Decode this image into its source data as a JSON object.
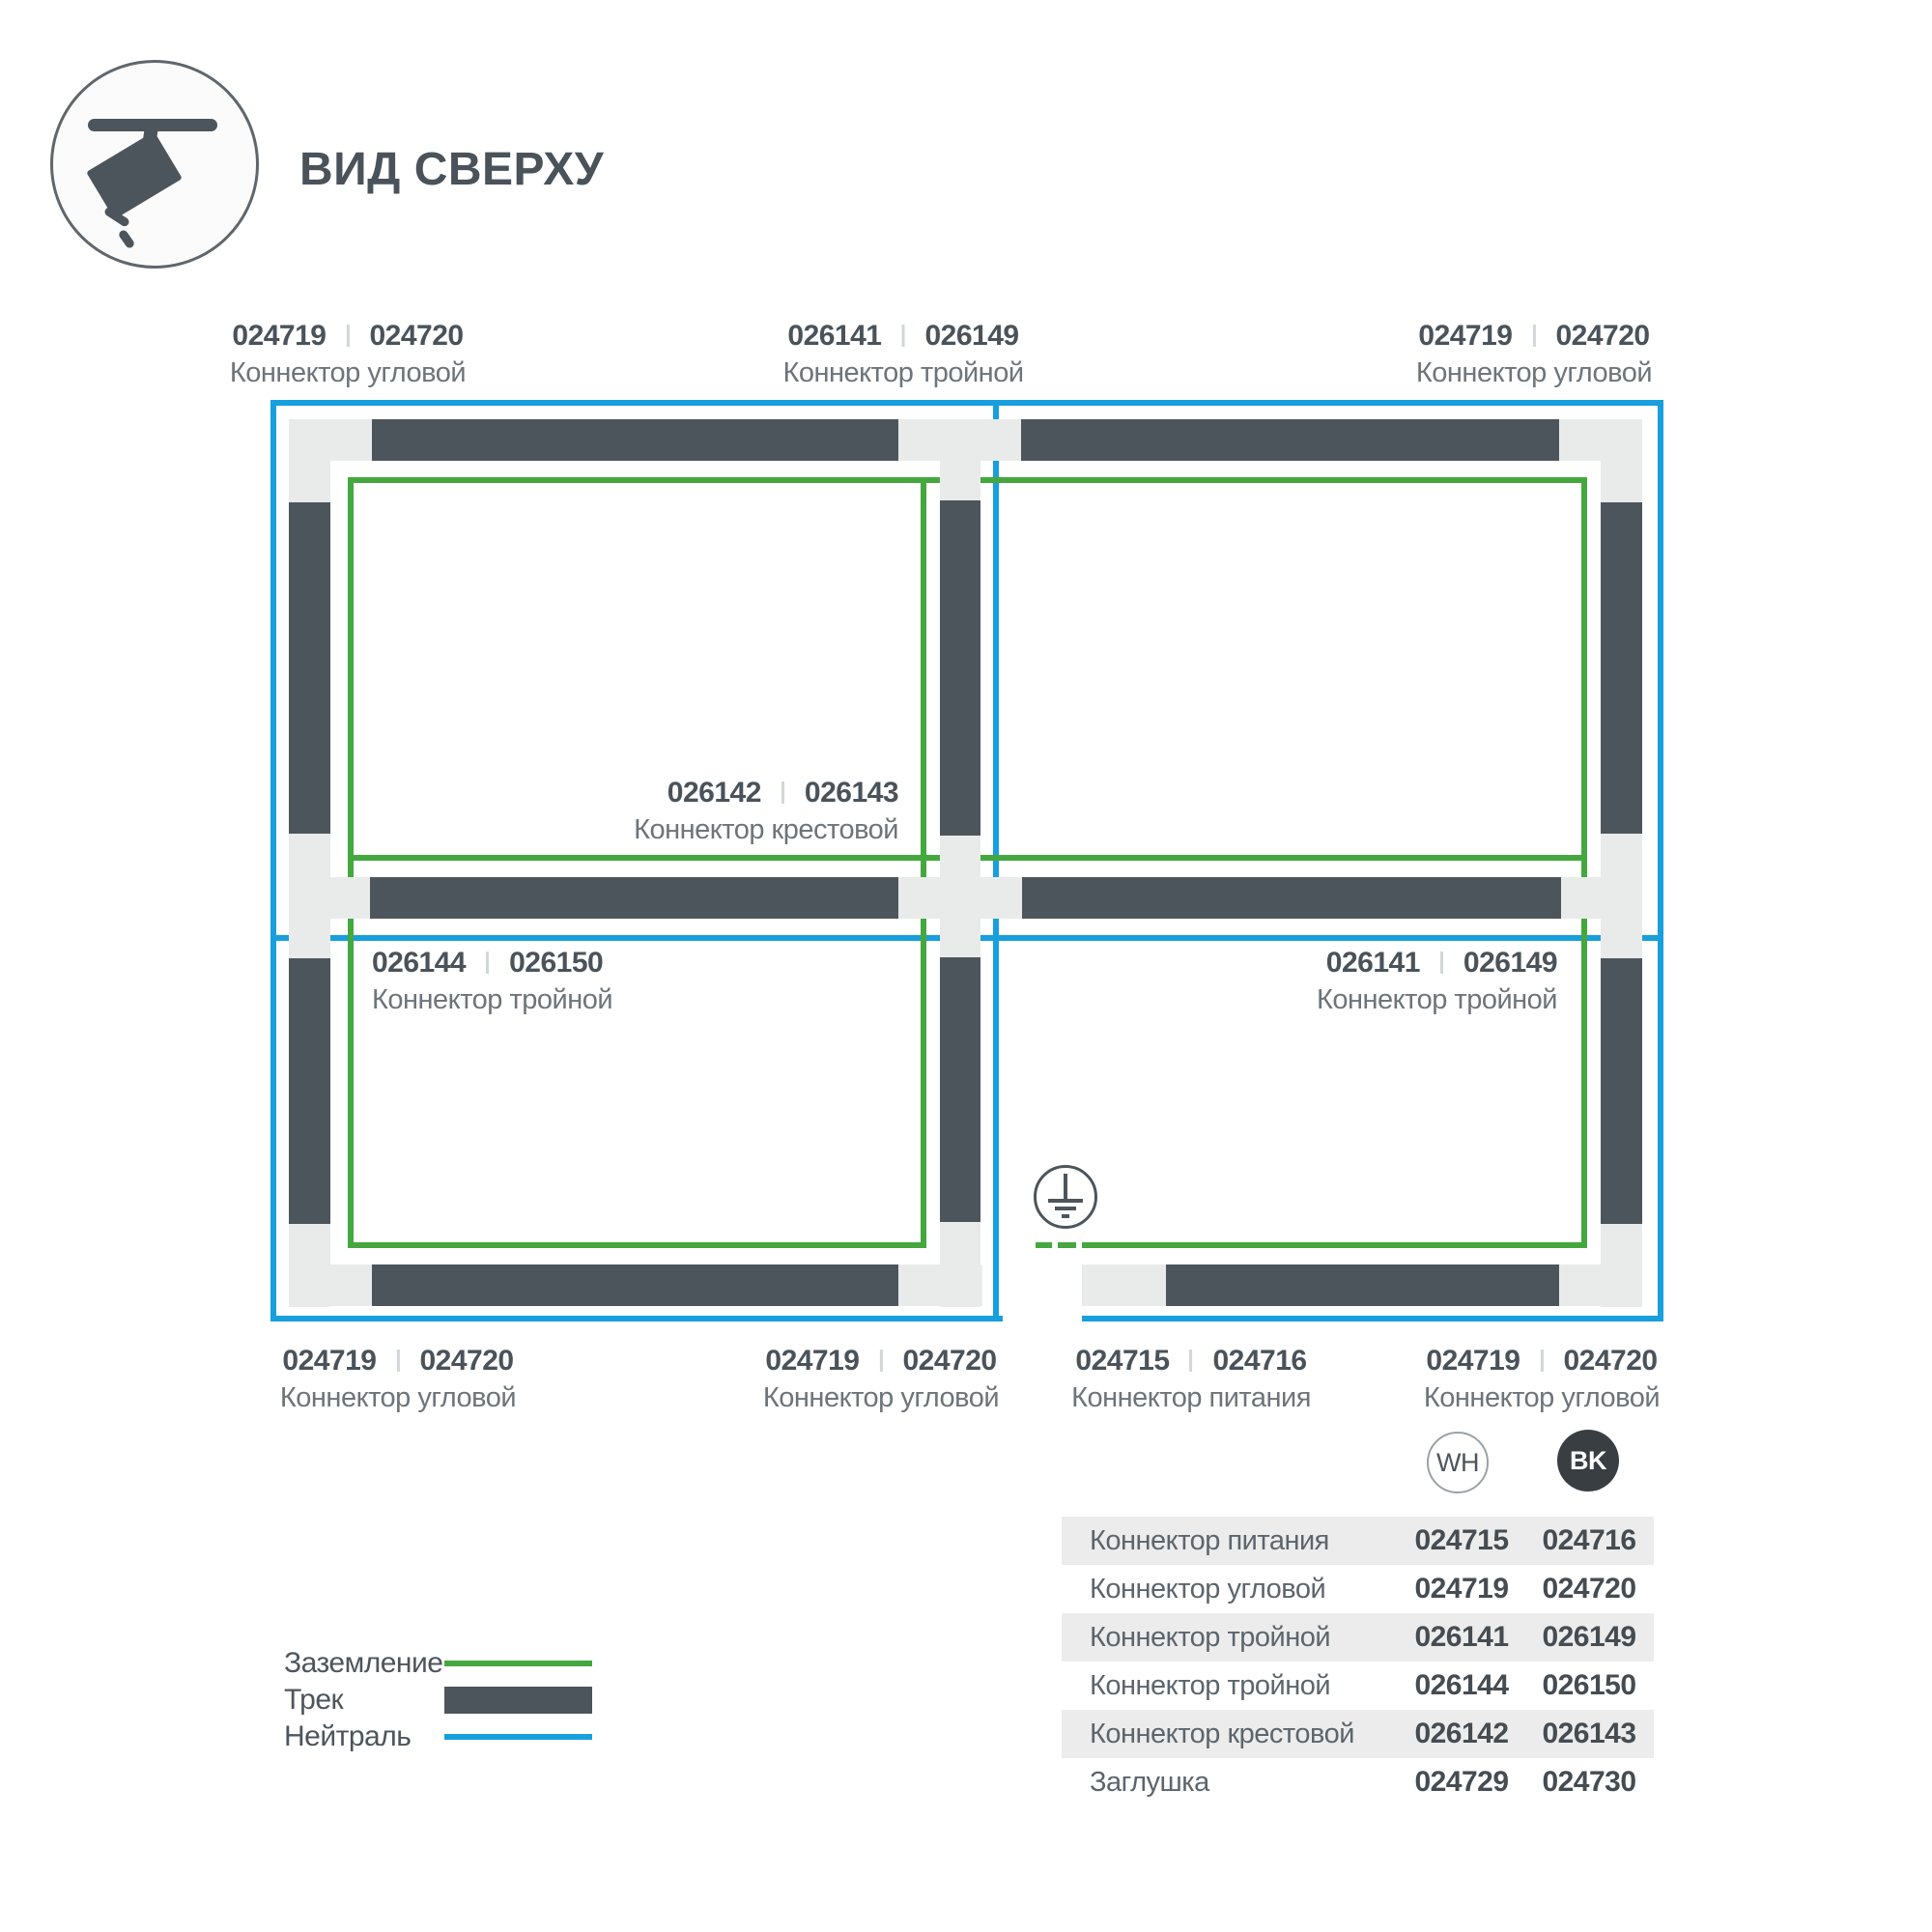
{
  "header": {
    "title": "ВИД СВЕРХУ"
  },
  "diagram": {
    "labels": [
      {
        "pos": "top-left",
        "wh": "024719",
        "bk": "024720",
        "name": "Коннектор угловой"
      },
      {
        "pos": "top-middle",
        "wh": "026141",
        "bk": "026149",
        "name": "Коннектор тройной"
      },
      {
        "pos": "top-right",
        "wh": "024719",
        "bk": "024720",
        "name": "Коннектор угловой"
      },
      {
        "pos": "center-cross",
        "wh": "026142",
        "bk": "026143",
        "name": "Коннектор крестовой"
      },
      {
        "pos": "middle-left",
        "wh": "026144",
        "bk": "026150",
        "name": "Коннектор тройной"
      },
      {
        "pos": "middle-right",
        "wh": "026141",
        "bk": "026149",
        "name": "Коннектор тройной"
      },
      {
        "pos": "bottom-left",
        "wh": "024719",
        "bk": "024720",
        "name": "Коннектор угловой"
      },
      {
        "pos": "bottom-middle",
        "wh": "024719",
        "bk": "024720",
        "name": "Коннектор угловой"
      },
      {
        "pos": "bottom-power",
        "wh": "024715",
        "bk": "024716",
        "name": "Коннектор питания"
      },
      {
        "pos": "bottom-right",
        "wh": "024719",
        "bk": "024720",
        "name": "Коннектор угловой"
      }
    ]
  },
  "legend": {
    "items": [
      {
        "label": "Заземление",
        "color": "#44a83e"
      },
      {
        "label": "Трек",
        "color": "#4d555c"
      },
      {
        "label": "Нейтраль",
        "color": "#189fdd"
      }
    ]
  },
  "variants": {
    "white": "WH",
    "black": "BK"
  },
  "table": {
    "rows": [
      {
        "name": "Коннектор питания",
        "wh": "024715",
        "bk": "024716"
      },
      {
        "name": "Коннектор угловой",
        "wh": "024719",
        "bk": "024720"
      },
      {
        "name": "Коннектор тройной",
        "wh": "026141",
        "bk": "026149"
      },
      {
        "name": "Коннектор тройной",
        "wh": "026144",
        "bk": "026150"
      },
      {
        "name": "Коннектор крестовой",
        "wh": "026142",
        "bk": "026143"
      },
      {
        "name": "Заглушка",
        "wh": "024729",
        "bk": "024730"
      }
    ]
  },
  "colors": {
    "ground": "#44a83e",
    "track": "#4d555c",
    "neutral": "#189fdd",
    "connector": "#e9ebeb"
  }
}
